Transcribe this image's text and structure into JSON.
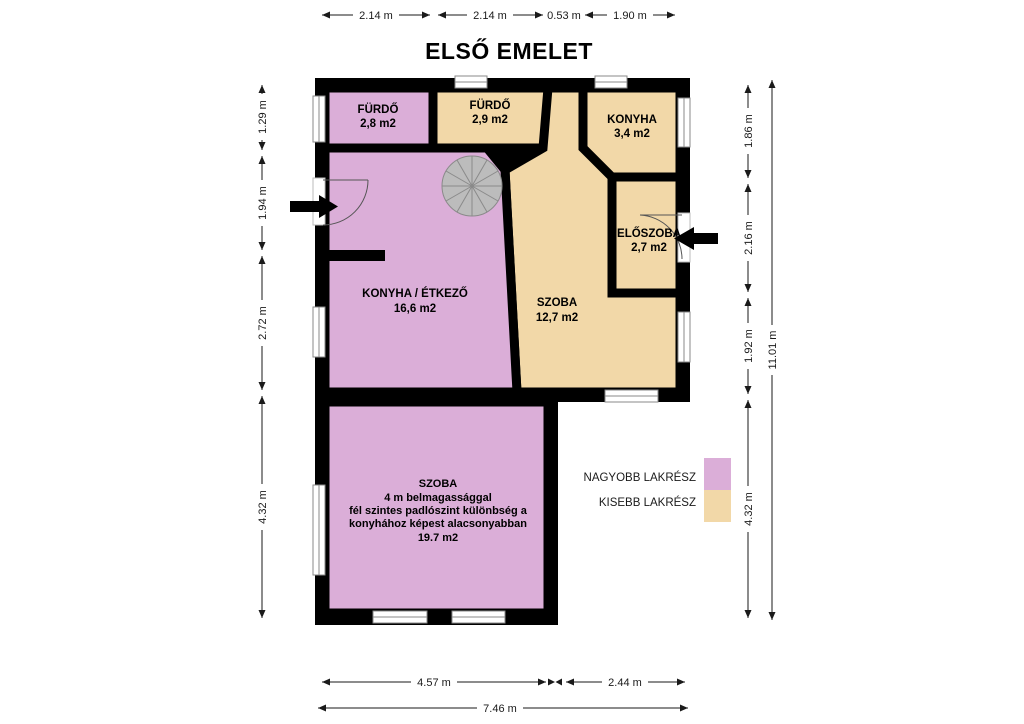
{
  "title": "ELSŐ EMELET",
  "colors": {
    "larger_unit": "#DBAED8",
    "smaller_unit": "#F2D8A8",
    "wall": "#000000",
    "stair": "#BCBCBC"
  },
  "rooms": {
    "furdo_1": {
      "name": "FÜRDŐ",
      "area": "2,8 m2"
    },
    "furdo_2": {
      "name": "FÜRDŐ",
      "area": "2,9 m2"
    },
    "konyha": {
      "name": "KONYHA",
      "area": "3,4 m2"
    },
    "eloszoba": {
      "name": "ELŐSZOBA",
      "area": "2,7 m2"
    },
    "konyha_etkezo": {
      "name": "KONYHA / ÉTKEZŐ",
      "area": "16,6 m2"
    },
    "szoba_kozepso": {
      "name": "SZOBA",
      "area": "12,7 m2"
    },
    "szoba_nagy": {
      "lines": [
        "SZOBA",
        "4 m belmagassággal",
        "fél szintes padlószint különbség a",
        "konyhához képest alacsonyabban",
        "19.7 m2"
      ]
    }
  },
  "dimensions": {
    "top": [
      "2.14 m",
      "2.14 m",
      "0.53 m",
      "1.90 m"
    ],
    "left": [
      "1.29 m",
      "1.94 m",
      "2.72 m",
      "4.32 m"
    ],
    "right": [
      "1.86 m",
      "2.16 m",
      "1.92 m",
      "4.32 m"
    ],
    "right_total": "11.01 m",
    "bottom": [
      "4.57 m",
      "2.44 m"
    ],
    "bottom_total": "7.46 m"
  },
  "legend": {
    "items": [
      {
        "label": "NAGYOBB LAKRÉSZ",
        "color": "#DBAED8"
      },
      {
        "label": "KISEBB LAKRÉSZ",
        "color": "#F2D8A8"
      }
    ]
  }
}
